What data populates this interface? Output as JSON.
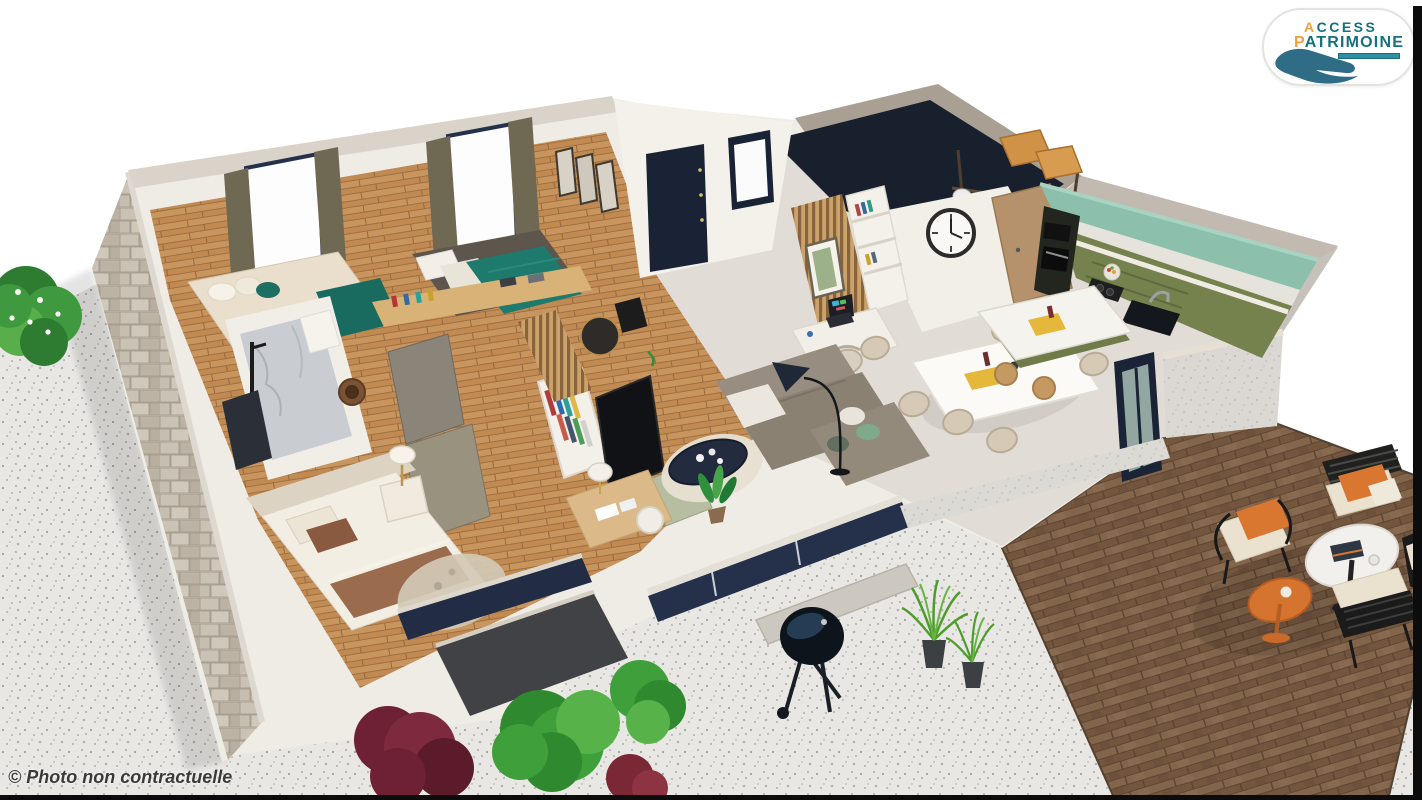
{
  "meta": {
    "kind": "3d-floorplan-render",
    "width_px": 1422,
    "height_px": 800
  },
  "logo": {
    "word1_accent": "A",
    "word1_rest": "CCESS",
    "word2_accent": "P",
    "word2_rest": "ATRIMOINE",
    "teal": "#17707f",
    "orange": "#f0a03c",
    "hand_color": "#2f6d86"
  },
  "caption": {
    "text": "© Photo non contractuelle"
  },
  "palette": {
    "background": "#ffffff",
    "terrazzo": "#e8e7e4",
    "deck_wood": "#7b5d46",
    "stone_wall": "#c3bbae",
    "wall_white": "#efece6",
    "wood_floor": "#c08a52",
    "tile_floor": "#e1ddd6",
    "navy": "#1a2335",
    "teal_bed": "#1d7a6c",
    "kitchen_olive": "#78854f",
    "kitchen_mint": "#8cc0ad",
    "sofa_taupe": "#8f8577",
    "orange_accent": "#d9762f",
    "curtain_olive": "#6f6853",
    "bush_green": "#3f9a3f",
    "bush_burgundy": "#6e2134",
    "edge_strip": "#0c0c0c"
  },
  "scene_elements": [
    "terrazzo-patio",
    "wood-deck",
    "flowering-shrub",
    "garden-bushes",
    "potted-grasses",
    "kettle-barbecue",
    "bedroom-daybed-teal",
    "bedroom-bed-teal",
    "bedroom-bed-brown",
    "bathroom-marble-shower",
    "wardrobe-clothes-rack",
    "tv-panel",
    "sofa-sectional",
    "coffee-table",
    "floor-lamp",
    "round-rug",
    "dining-table-chairs",
    "kitchen-green-cabinets",
    "kitchen-island",
    "wall-clock",
    "front-door-navy",
    "storage-shelf-boxes",
    "outdoor-lounge-chairs",
    "round-bistro-table",
    "orange-side-table"
  ]
}
